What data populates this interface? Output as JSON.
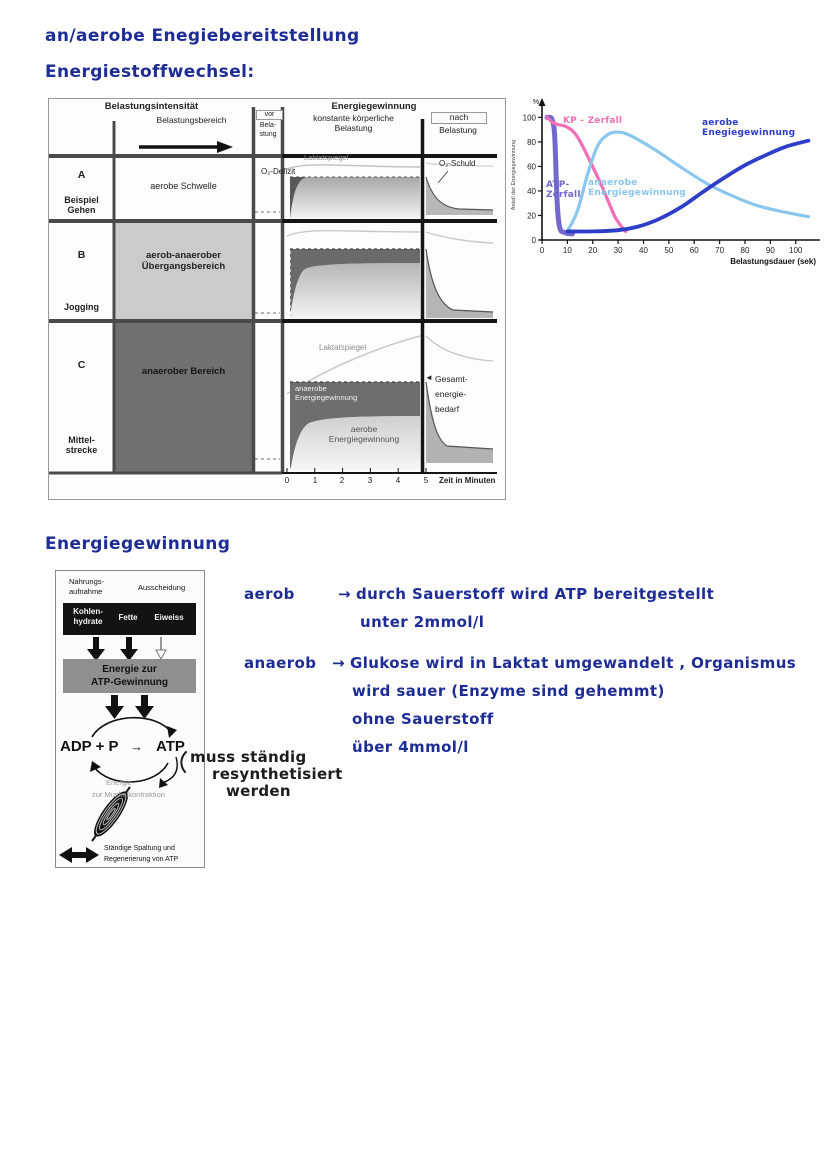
{
  "page": {
    "title": "an/aerobe Enegiebereitstellung",
    "heading_stoffwechsel": "Energiestoffwechsel:",
    "heading_gewinnung": "Energiegewinnung",
    "ink_blue": "#1e2d96",
    "ink_black": "#1c1c1c"
  },
  "figure": {
    "header_left": "Belastungsintensität",
    "header_mid": "Energiegewinnung",
    "col_belastungsbereich": "Belastungsbereich",
    "col_vor_line1": "vor",
    "col_vor_line2": "Bela-",
    "col_vor_line3": "stung",
    "col_konstant": "konstante körperliche\nBelastung",
    "col_nach_line1": "nach",
    "col_nach_line2": "Belastung",
    "rows": [
      {
        "letter": "A",
        "example": "Beispiel\nGehen",
        "zone": "aerobe Schwelle"
      },
      {
        "letter": "B",
        "example": "Jogging",
        "zone": "aerob-anaerober\nÜbergangsbereich"
      },
      {
        "letter": "C",
        "example": "Mittel-\nstrecke",
        "zone": "anaerober Bereich"
      }
    ],
    "labels": {
      "laktat_a": "Laktatspiegel",
      "o2_defizit": "O₂-Defizit",
      "o2_schuld": "O₂-Schuld",
      "laktat_c": "Laktatspiegel",
      "anaerobe_band": "anaerobe\nEnergiegewinnung",
      "aerobe_band": "aerobe\nEnergiegewinnung",
      "gesamt_arrow": "◄",
      "gesamt": "Gesamt-\nenergie-\nbedarf",
      "zeit": "Zeit in Minuten",
      "time_ticks": [
        "0",
        "1",
        "2",
        "3",
        "4",
        "5"
      ]
    }
  },
  "chart_data": {
    "type": "line",
    "title": "",
    "xlabel": "Belastungsdauer (sek)",
    "ylabel": "Anteil der Energiegewinnung",
    "y_unit": "%",
    "xlim": [
      0,
      108
    ],
    "ylim": [
      0,
      106
    ],
    "x_ticks": [
      0,
      10,
      20,
      30,
      40,
      50,
      60,
      70,
      80,
      90,
      100
    ],
    "y_ticks": [
      0,
      20,
      40,
      60,
      80,
      100
    ],
    "grid": false,
    "legend_position": "labels-on-curves",
    "series": [
      {
        "name": "ATP-Zerfall",
        "color": "#7468cf",
        "points": [
          [
            2,
            100
          ],
          [
            3,
            100
          ],
          [
            4,
            98
          ],
          [
            5,
            85
          ],
          [
            6,
            30
          ],
          [
            7,
            10
          ],
          [
            9,
            6
          ],
          [
            12,
            5
          ]
        ]
      },
      {
        "name": "KP-Zerfall",
        "color": "#f06fb5",
        "points": [
          [
            2,
            100
          ],
          [
            5,
            95
          ],
          [
            10,
            92
          ],
          [
            14,
            84
          ],
          [
            19,
            64
          ],
          [
            24,
            42
          ],
          [
            29,
            18
          ],
          [
            33,
            7
          ]
        ]
      },
      {
        "name": "anaerobe Energiegewinnung",
        "color": "#8ac6ee",
        "points": [
          [
            10,
            7
          ],
          [
            14,
            24
          ],
          [
            18,
            54
          ],
          [
            22,
            77
          ],
          [
            26,
            86
          ],
          [
            30,
            88
          ],
          [
            35,
            85
          ],
          [
            45,
            73
          ],
          [
            55,
            59
          ],
          [
            65,
            46
          ],
          [
            75,
            36
          ],
          [
            85,
            28
          ],
          [
            95,
            23
          ],
          [
            105,
            19
          ]
        ]
      },
      {
        "name": "aerobe Enegiegewinnung",
        "color": "#2f3ec8",
        "points": [
          [
            10,
            7
          ],
          [
            20,
            7
          ],
          [
            30,
            8
          ],
          [
            38,
            11
          ],
          [
            46,
            17
          ],
          [
            55,
            27
          ],
          [
            64,
            40
          ],
          [
            72,
            51
          ],
          [
            80,
            61
          ],
          [
            88,
            69
          ],
          [
            96,
            76
          ],
          [
            105,
            81
          ]
        ]
      }
    ],
    "curve_labels": [
      {
        "text": "KP - Zerfall",
        "color": "#f06fb5",
        "x": 55,
        "y": 20
      },
      {
        "text": "ATP-\nZerfall",
        "color": "#7468cf",
        "x": 38,
        "y": 84
      },
      {
        "text": "anaerobe\nEnergiegewinnung",
        "color": "#8ac6ee",
        "x": 80,
        "y": 82
      },
      {
        "text": "aerobe\nEnegiegewinnung",
        "color": "#2f3ec8",
        "x": 194,
        "y": 22
      }
    ]
  },
  "atp_diagram": {
    "intake": "Nahrungs-\naufnahme",
    "excretion": "Ausscheidung",
    "nutrients": [
      "Kohlen-\nhydrate",
      "Fette",
      "Eiweiss"
    ],
    "energy_box": "Energie zur\nATP-Gewinnung",
    "adp": "ADP + P",
    "cycle_arrow": "→",
    "atp": "ATP",
    "muscle_energy_line1": "Energie",
    "muscle_energy_line2": "zur Muskelkontraktion",
    "bottom_note": "Ständige Spaltung und\nRegenerierung von ATP"
  },
  "notes": {
    "aerob_term": "aerob",
    "aerob_arrow": "→",
    "aerob_line1": "durch Sauerstoff wird ATP bereitgestellt",
    "aerob_line2": "unter 2mmol/l",
    "anaerob_term": "anaerob",
    "anaerob_arrow": "→",
    "anaerob_line1": "Glukose wird in Laktat umgewandelt , Organismus",
    "anaerob_line2": "wird sauer (Enzyme sind gehemmt)",
    "anaerob_line3": "ohne Sauerstoff",
    "anaerob_line4": "über 4mmol/l",
    "resynth_line1": "muss ständig",
    "resynth_line2": "resynthetisiert",
    "resynth_line3": "werden"
  }
}
